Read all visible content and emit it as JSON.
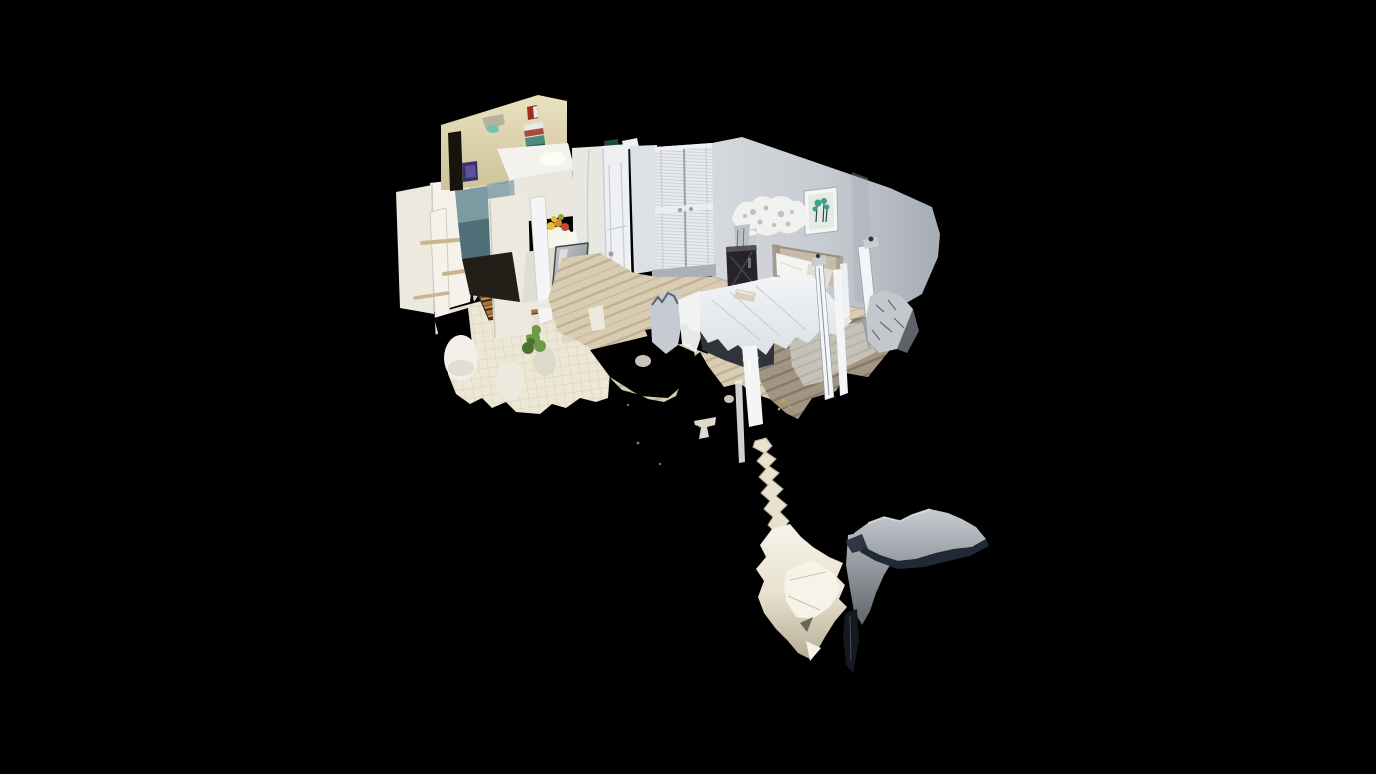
{
  "viewer": {
    "view_mode": "dollhouse-3d",
    "background": "#000000",
    "scene_description": "Isometric 3D scan cutaway of a studio apartment: bathroom with grab bars and tiled floor at left, kitchen with teal backsplash, fruit bowl and stainless dishwasher, open white door and louvered closet in the middle, bedroom at right with four-poster bed, framed artwork, ceiling fan blob, nightstand with lamp and draped chair; torn mesh fragments (curtains, mirror reflections) dangle below the floor into black space.",
    "rooms": [
      "bathroom",
      "kitchen",
      "hallway",
      "closet",
      "bedroom"
    ],
    "objects": [
      "grab-bars",
      "toilet",
      "floor-mat",
      "plant",
      "tile-floor",
      "fire-alarm",
      "wall-poster",
      "wall-sconce",
      "fruit-bowl",
      "dishwasher",
      "kitchen-counter",
      "open-door",
      "louvered-closet-doors",
      "framed-picture",
      "ceiling-fan",
      "nightstand",
      "lamp",
      "bed",
      "pillows",
      "bed-posts",
      "draped-chair",
      "wood-floor",
      "rug",
      "mesh-fragments"
    ]
  },
  "palette": {
    "bg": "#000000",
    "black": "#000000",
    "cream_wall": "#e9e1bf",
    "cream_wall_dark": "#cfc29a",
    "hole_dark": "#17130e",
    "alarm_red": "#a02d24",
    "art_purple": "#38306b",
    "art_purple_light": "#5c5298",
    "sconce_gray": "#b7b1a4",
    "sconce_glow": "#5ec3b0",
    "poster_white": "#e6ebe3",
    "poster_red": "#a84a3e",
    "poster_teal": "#4a8d7e",
    "poster_teal_dark": "#1f5b50",
    "panel_white": "#eceadf",
    "panel_bright": "#f4f2ea",
    "panel_shadow": "#ddd9cb",
    "panel_seam": "#cfccbe",
    "bar_tan": "#c9b68c",
    "tile_bg": "#ede7d5",
    "tile_line": "#d7d0bb",
    "mat_dark": "#2e2417",
    "mat_brown": "#a8713f",
    "mat_light": "#c8914f",
    "toilet_white": "#f1efe7",
    "plant_green": "#6f9a4a",
    "plant_dark": "#4d7332",
    "backsplash_teal": "#7d99a1",
    "backsplash_blue": "#95abb2",
    "backsplash_teal_dark": "#4f6f78",
    "cabinet_white": "#f4f2ec",
    "cabinet_face": "#e9e6de",
    "glow_white": "#fdfdf6",
    "counter_bright": "#f7f6f0",
    "counter_front": "#e0ddd3",
    "column_white": "#e8e8e2",
    "stainless_light": "#c9ced2",
    "stainless_dark": "#798085",
    "stainless_frame": "#45494d",
    "under_dark": "#231e18",
    "fruit_yellow": "#e3bd37",
    "fruit_orange": "#d8892f",
    "fruit_red": "#c24a2e",
    "fruit_green": "#8ba03e",
    "bowl_white": "#f4f3ec",
    "door_white": "#eef0f2",
    "door_shadow": "#c9ced4",
    "sliver_dark": "#1b2629",
    "sliver_glint": "#3fb9ad",
    "wall_gray_light": "#dde0e5",
    "wall_gray_mid": "#c6cbd1",
    "wall_gray_dark": "#a7adb5",
    "seam_gray": "#9ba1a7",
    "louver_line": "#ccd1d7",
    "closet_white": "#e9ebee",
    "baseboard_gray": "#aab0b6",
    "picture_frame": "#f4f5f4",
    "frame_edge": "#aeb2b6",
    "picture_bg": "#e3ebe5",
    "picture_green": "#3f9f8a",
    "picture_stem": "#2c4a42",
    "fan_white": "#f1f1ef",
    "fan_hole": "#a9adb2",
    "fan_stem": "#c9ced1",
    "lamp_gray": "#bcc0c3",
    "nightstand_dark": "#26232a",
    "nightstand_hi": "#55505c",
    "headboard_tan": "#c6baab",
    "headboard_dark": "#9a8f81",
    "pillow_white": "#f4f4f2",
    "pillow_shadow": "#d8d8d2",
    "pillow_gray": "#e2ded4",
    "mattress_top": "#f3f5f6",
    "mattress_mid": "#dce1e6",
    "fold": "#c4cbd1",
    "base_dark": "#2f333a",
    "book_tan": "#d9d0bf",
    "post_bright": "#f3f5f7",
    "post_edge": "#8d939a",
    "post_knob": "#33383d",
    "chair_gray": "#9aa0a5",
    "drape_silver": "#c4c8cc",
    "drape_dark": "#5d6268",
    "wood_base": "#d8ccb3",
    "wood_stripe1": "#c2b295",
    "wood_stripe2": "#cbbc9f",
    "wood_dark_base": "#9c8f7c",
    "wood_dark_stripe": "#7c7162",
    "rug_gray": "#c9c6bf",
    "rug_stripe": "#b8b4ab",
    "frag_cream": "#e8e2cf",
    "frag_cream_bright": "#f6f3e8",
    "frag_shadow": "#b6ad96",
    "frag_deep": "#6b6455",
    "sheet_top": "#b4bac0",
    "sheet_bottom": "#5f656b",
    "wing_light": "#c8cdd2",
    "wing_mid": "#979da4",
    "wing_navy": "#222936",
    "tail_dark": "#14181f",
    "gold": "#c9a23c",
    "speck": "#938e83"
  }
}
